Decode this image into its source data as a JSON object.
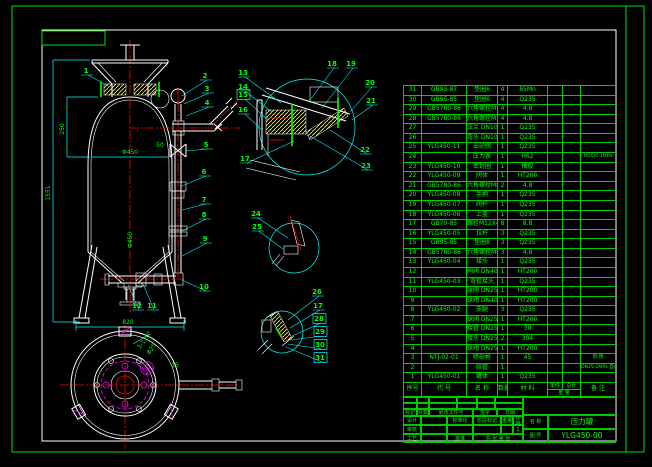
{
  "colors": {
    "background": "#000000",
    "frame_green": "#00e400",
    "text_green": "#00ff00",
    "dim_cyan": "#00ffff",
    "geometry_white": "#ffffff",
    "centerline_red": "#ff0000",
    "hatch_yellow": "#ffff00",
    "detail_magenta": "#ff00ff"
  },
  "title_block": {
    "mark": "标记",
    "count": "处数",
    "change_doc": "更改文件号",
    "sign": "签字",
    "date": "日期",
    "design": "设计",
    "check": "审核",
    "process": "工艺",
    "standard": "标准化",
    "approve": "批准",
    "stage": "阶段标记",
    "weight": "重量",
    "scale": "比例",
    "scale_val": "1",
    "sheets": "共 张 第 张",
    "name_label": "名 称",
    "name": "压力罐",
    "no_label": "图 号",
    "drawing_no": "YLG450-00"
  },
  "bom": {
    "headers": {
      "no": "序号",
      "code": "代 号",
      "name": "名 称",
      "qty": "数量",
      "material": "材 料",
      "unit": "单件",
      "total": "总计",
      "weight": "重 量",
      "remark": "备 注"
    },
    "rows": [
      {
        "no": "31",
        "code": "GB93-87",
        "name": "垫圈6",
        "qty": "4",
        "material": "85Mn",
        "unit": "",
        "total": "",
        "remark": ""
      },
      {
        "no": "30",
        "code": "GB95-85",
        "name": "垫圈6",
        "qty": "4",
        "material": "Q235",
        "unit": "",
        "total": "",
        "remark": ""
      },
      {
        "no": "29",
        "code": "GB5780-86",
        "name": "六角螺栓M18",
        "qty": "4",
        "material": "4.8",
        "unit": "",
        "total": "",
        "remark": ""
      },
      {
        "no": "28",
        "code": "GB5780-86",
        "name": "六角螺栓M16X50",
        "qty": "4",
        "material": "4.8",
        "unit": "",
        "total": "",
        "remark": ""
      },
      {
        "no": "27",
        "code": "",
        "name": "法兰 DN100",
        "qty": "1",
        "material": "Q235",
        "unit": "",
        "total": "",
        "remark": ""
      },
      {
        "no": "26",
        "code": "",
        "name": "弯头 DN100",
        "qty": "1",
        "material": "Q235",
        "unit": "",
        "total": "",
        "remark": ""
      },
      {
        "no": "25",
        "code": "YLG450-11",
        "name": "出砂阀",
        "qty": "1",
        "material": "Q235",
        "unit": "",
        "total": "",
        "remark": ""
      },
      {
        "no": "24",
        "code": "",
        "name": "压力表",
        "qty": "1",
        "material": "H62",
        "unit": "",
        "total": "",
        "remark": "M20/0-1MPa"
      },
      {
        "no": "23",
        "code": "YLG450-10",
        "name": "密封圈",
        "qty": "1",
        "material": "橡胶",
        "unit": "",
        "total": "",
        "remark": ""
      },
      {
        "no": "22",
        "code": "YLG450-09",
        "name": "阀体",
        "qty": "1",
        "material": "HT200",
        "unit": "",
        "total": "",
        "remark": ""
      },
      {
        "no": "21",
        "code": "GB5780-86",
        "name": "六角螺栓M8",
        "qty": "2",
        "material": "4.8",
        "unit": "",
        "total": "",
        "remark": ""
      },
      {
        "no": "20",
        "code": "YLG450-08",
        "name": "手柄",
        "qty": "1",
        "material": "Q235",
        "unit": "",
        "total": "",
        "remark": ""
      },
      {
        "no": "19",
        "code": "YLG450-07",
        "name": "阀杆",
        "qty": "1",
        "material": "Q235",
        "unit": "",
        "total": "",
        "remark": ""
      },
      {
        "no": "18",
        "code": "YLG450-06",
        "name": "上盖",
        "qty": "1",
        "material": "Q235",
        "unit": "",
        "total": "",
        "remark": ""
      },
      {
        "no": "17",
        "code": "GB70-85",
        "name": "螺栓M12X40",
        "qty": "8",
        "material": "8.8",
        "unit": "",
        "total": "",
        "remark": ""
      },
      {
        "no": "16",
        "code": "YLG450-05",
        "name": "拉杆",
        "qty": "3",
        "material": "Q235",
        "unit": "",
        "total": "",
        "remark": ""
      },
      {
        "no": "15",
        "code": "GB95-85",
        "name": "垫圈8",
        "qty": "3",
        "material": "Q235",
        "unit": "",
        "total": "",
        "remark": ""
      },
      {
        "no": "14",
        "code": "GB5780-86",
        "name": "六角螺栓M8X15",
        "qty": "3",
        "material": "4.8",
        "unit": "",
        "total": "",
        "remark": ""
      },
      {
        "no": "13",
        "code": "YLG450-04",
        "name": "接头",
        "qty": "1",
        "material": "Q235",
        "unit": "",
        "total": "",
        "remark": ""
      },
      {
        "no": "12",
        "code": "",
        "name": "闸阀 DN40",
        "qty": "1",
        "material": "HT200",
        "unit": "",
        "total": "",
        "remark": ""
      },
      {
        "no": "11",
        "code": "YLG450-03",
        "name": "弯管接头",
        "qty": "1",
        "material": "Q235",
        "unit": "",
        "total": "",
        "remark": ""
      },
      {
        "no": "10",
        "code": "",
        "name": "球阀 DN25",
        "qty": "1",
        "material": "HT200",
        "unit": "",
        "total": "",
        "remark": ""
      },
      {
        "no": "9",
        "code": "",
        "name": "球阀 DN40",
        "qty": "1",
        "material": "HT200",
        "unit": "",
        "total": "",
        "remark": ""
      },
      {
        "no": "8",
        "code": "YLG450-02",
        "name": "支腿",
        "qty": "3",
        "material": "Q235",
        "unit": "",
        "total": "",
        "remark": ""
      },
      {
        "no": "7",
        "code": "",
        "name": "球阀 DN25",
        "qty": "1",
        "material": "HT200",
        "unit": "",
        "total": "",
        "remark": ""
      },
      {
        "no": "6",
        "code": "",
        "name": "接管 DN25",
        "qty": "1",
        "material": "30",
        "unit": "",
        "total": "",
        "remark": ""
      },
      {
        "no": "5",
        "code": "",
        "name": "接头 DN25",
        "qty": "2",
        "material": "304",
        "unit": "",
        "total": "",
        "remark": ""
      },
      {
        "no": "4",
        "code": "",
        "name": "球阀 DN25",
        "qty": "1",
        "material": "HT200",
        "unit": "",
        "total": "",
        "remark": ""
      },
      {
        "no": "3",
        "code": "NTJ-02-01",
        "name": "喷砂枪",
        "qty": "1",
        "material": "45",
        "unit": "",
        "total": "",
        "remark": "借 用"
      },
      {
        "no": "2",
        "code": "",
        "name": "胶管",
        "qty": "1",
        "material": "",
        "unit": "",
        "total": "",
        "remark": "DN25-1MPa 自备"
      },
      {
        "no": "1",
        "code": "YLG450-01",
        "name": "罐体",
        "qty": "1",
        "material": "Q235",
        "unit": "",
        "total": "",
        "remark": ""
      }
    ]
  },
  "drawing": {
    "dims": [
      {
        "t": "1551",
        "x": 50,
        "y": 193,
        "rot": -90
      },
      {
        "t": "250",
        "x": 64,
        "y": 129,
        "rot": -90
      },
      {
        "t": "Φ450",
        "x": 130,
        "y": 154,
        "rot": 0
      },
      {
        "t": "Φ450",
        "x": 132,
        "y": 240,
        "rot": -90
      },
      {
        "t": "50",
        "x": 160,
        "y": 147,
        "rot": 0
      },
      {
        "t": "820",
        "x": 128,
        "y": 324,
        "rot": 0
      },
      {
        "t": "3-120°",
        "x": 146,
        "y": 341,
        "rot": -55
      },
      {
        "t": "Φ25",
        "x": 153,
        "y": 350,
        "rot": -55
      },
      {
        "t": "15",
        "x": 175,
        "y": 367,
        "rot": 0
      }
    ],
    "callouts": [
      {
        "n": "1",
        "x": 86,
        "y": 73,
        "tx": 108,
        "ty": 86
      },
      {
        "n": "2",
        "x": 205,
        "y": 78,
        "tx": 182,
        "ty": 96
      },
      {
        "n": "3",
        "x": 207,
        "y": 91,
        "tx": 184,
        "ty": 104
      },
      {
        "n": "4",
        "x": 207,
        "y": 105,
        "tx": 186,
        "ty": 116
      },
      {
        "n": "5",
        "x": 206,
        "y": 147,
        "tx": 186,
        "ty": 151
      },
      {
        "n": "6",
        "x": 204,
        "y": 174,
        "tx": 182,
        "ty": 186
      },
      {
        "n": "7",
        "x": 204,
        "y": 202,
        "tx": 182,
        "ty": 210
      },
      {
        "n": "8",
        "x": 204,
        "y": 217,
        "tx": 182,
        "ty": 231
      },
      {
        "n": "9",
        "x": 205,
        "y": 241,
        "tx": 182,
        "ty": 256
      },
      {
        "n": "10",
        "x": 204,
        "y": 289,
        "tx": 182,
        "ty": 280
      },
      {
        "n": "11",
        "x": 152,
        "y": 308,
        "tx": 143,
        "ty": 284
      },
      {
        "n": "12",
        "x": 137,
        "y": 308,
        "tx": 128,
        "ty": 285
      },
      {
        "n": "13",
        "x": 243,
        "y": 75,
        "tx": 281,
        "ty": 103
      },
      {
        "n": "14",
        "x": 243,
        "y": 89,
        "tx": 272,
        "ty": 112
      },
      {
        "n": "15",
        "x": 243,
        "y": 97,
        "boxed": true,
        "tx": 268,
        "ty": 120
      },
      {
        "n": "16",
        "x": 243,
        "y": 112,
        "tx": 262,
        "ty": 130
      },
      {
        "n": "17",
        "x": 245,
        "y": 161,
        "tx": 294,
        "ty": 141
      },
      {
        "n": "18",
        "x": 332,
        "y": 66,
        "tx": 310,
        "ty": 100
      },
      {
        "n": "19",
        "x": 351,
        "y": 66,
        "tx": 322,
        "ty": 108
      },
      {
        "n": "20",
        "x": 370,
        "y": 85,
        "tx": 350,
        "ty": 112
      },
      {
        "n": "21",
        "x": 371,
        "y": 103,
        "tx": 352,
        "ty": 120
      },
      {
        "n": "22",
        "x": 365,
        "y": 152,
        "tx": 330,
        "ty": 130
      },
      {
        "n": "23",
        "x": 366,
        "y": 168,
        "tx": 310,
        "ty": 136
      },
      {
        "n": "24",
        "x": 256,
        "y": 216,
        "tx": 288,
        "ty": 238
      },
      {
        "n": "25",
        "x": 257,
        "y": 229,
        "tx": 283,
        "ty": 249
      },
      {
        "n": "26",
        "x": 317,
        "y": 294,
        "tx": 288,
        "ty": 320
      },
      {
        "n": "17",
        "x": 318,
        "y": 308,
        "tx": 290,
        "ty": 328
      },
      {
        "n": "28",
        "x": 319,
        "y": 321,
        "boxed": true,
        "tx": 292,
        "ty": 336
      },
      {
        "n": "29",
        "x": 320,
        "y": 334,
        "boxed": true,
        "tx": 290,
        "ty": 340
      },
      {
        "n": "30",
        "x": 320,
        "y": 347,
        "boxed": true,
        "tx": 288,
        "ty": 344
      },
      {
        "n": "31",
        "x": 320,
        "y": 360,
        "boxed": true,
        "tx": 286,
        "ty": 347
      }
    ]
  }
}
